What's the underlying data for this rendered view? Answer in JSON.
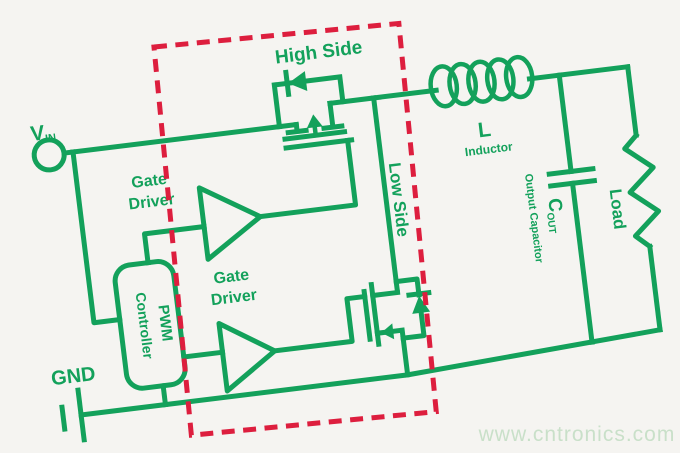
{
  "colors": {
    "line_green": "#13a15b",
    "dashed_red": "#dd1e3e",
    "background": "#f5f4f1",
    "watermark_green": "#c9e0c9"
  },
  "labels": {
    "vin": "V",
    "vin_sub": "IN",
    "gnd": "GND",
    "high_side": "High Side",
    "low_side": "Low Side",
    "gate_driver_upper": {
      "line1": "Gate",
      "line2": "Driver"
    },
    "gate_driver_lower": {
      "line1": "Gate",
      "line2": "Driver"
    },
    "pwm": {
      "line1": "PWM",
      "line2": "Controller"
    },
    "inductor": {
      "ref": "L",
      "name": "Inductor"
    },
    "output_capacitor": {
      "ref": "C",
      "ref_sub": "OUT",
      "name": "Output Capacitor"
    },
    "load": "Load"
  },
  "watermark": {
    "text": "www.cntronics.com"
  }
}
